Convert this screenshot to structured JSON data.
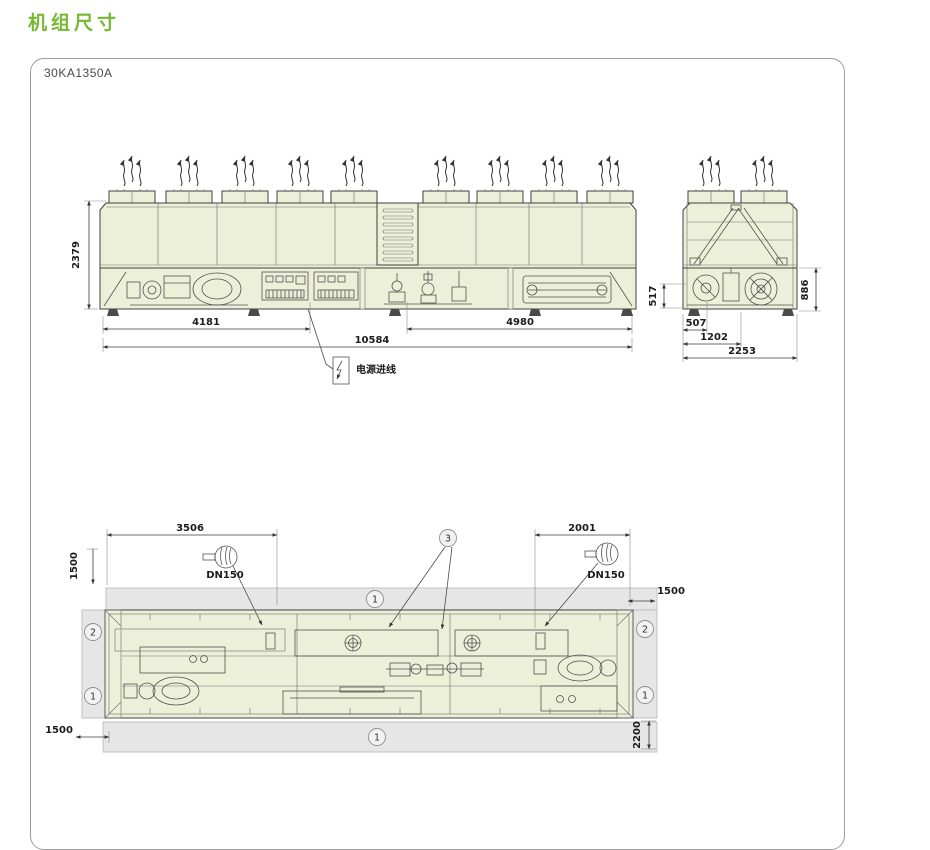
{
  "page": {
    "title": "机组尺寸",
    "model": "30KA1350A"
  },
  "colors": {
    "accent": "#76b832",
    "line": "#3f3f3f",
    "unit_fill": "#edf0d8",
    "clearance_fill": "#e6e6e6",
    "panel_border": "#9c9c9c"
  },
  "front_view": {
    "dim_height": "2379",
    "dim_left_section": "4181",
    "dim_right_section": "4980",
    "dim_total_length": "10584",
    "power_inlet_label": "电源进线"
  },
  "side_view": {
    "dim_left_height": "517",
    "dim_right_height": "886",
    "dim_width_1": "507",
    "dim_width_2": "1202",
    "dim_width_3": "2253"
  },
  "plan_view": {
    "dim_left_connection": "3506",
    "dim_right_connection": "2001",
    "dim_clearance_top_left": "1500",
    "dim_clearance_top_right": "1500",
    "dim_clearance_bottom_left": "1500",
    "dim_clearance_bottom_right": "2200",
    "port_left_label": "DN150",
    "port_right_label": "DN150",
    "callout_1": "1",
    "callout_2": "2",
    "callout_3": "3"
  }
}
